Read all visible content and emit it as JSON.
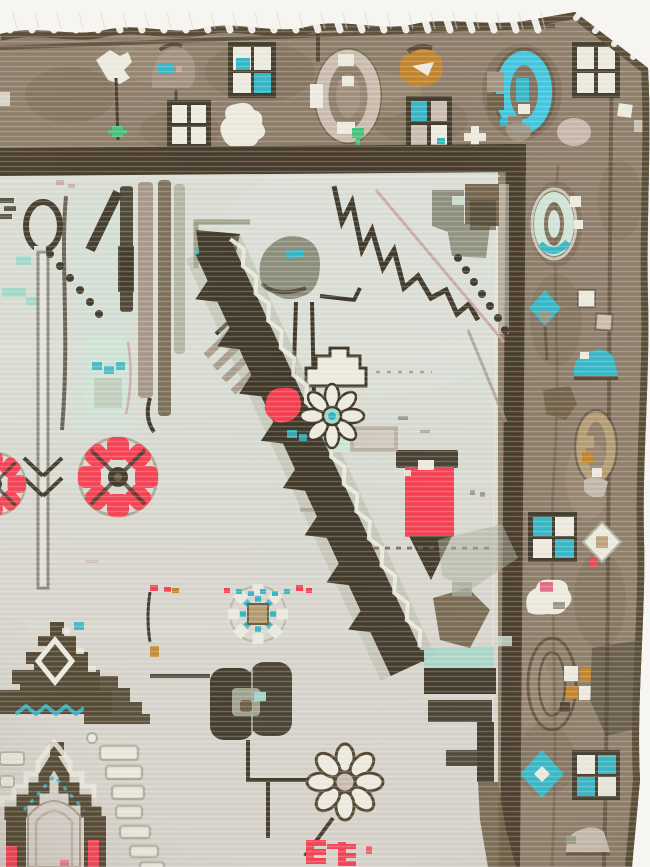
{
  "canvas": {
    "width": 650,
    "height": 867
  },
  "scene": {
    "type": "photograph",
    "subject": "Top corner detail of a worn vintage hand-knotted wool rug photographed on a white background, with fringe along the top edge",
    "no_visible_text": true,
    "regions": {
      "top_border_motifs": [
        "white-flower-sprig",
        "taupe-palmette",
        "teal-white-windowpane",
        "white-windowpane",
        "white-rosette-blob",
        "beige-oval-rosette",
        "orange-palmette",
        "mixed-windowpane",
        "white-cross",
        "turquoise-oval-rosette",
        "corner-white-windowpane",
        "green-sprout"
      ],
      "right_border_motifs": [
        "mint-oval-rosette",
        "white-square-chain",
        "teal-diamond-flower",
        "teal-mound",
        "tan-oval-rosette",
        "teal-checkerboard",
        "white-diamond",
        "white-blob-with-pink",
        "concentric-oval-with-squares",
        "teal-diamond-medallion",
        "teal-white-checkerboard",
        "beige-mound"
      ],
      "field_motifs": [
        "looped-spindle-pole",
        "vertical-bar-cluster",
        "bird-like-palmette",
        "stepped-cloud",
        "zigzag-vine",
        "pink-diagonal-abrash-line",
        "sawtooth-diagonal-leaf",
        "red-pinwheel-rosettes",
        "mint-bud",
        "daisy-with-teal-center",
        "red-pendant-flower",
        "teal-dotted-rosette",
        "dark-olive-double-flower",
        "outlined-pinwheel-flower",
        "red-comb-motifs",
        "stepped-pyramid",
        "stepped-gable-with-red-bars",
        "white-step-ladder",
        "teal-zigzag-line"
      ]
    }
  },
  "palette": {
    "photoBg": "#f6f5f1",
    "field": "#d8dcd3",
    "fieldWarm": "#d7cec8",
    "borderBrown": "#8b7a66",
    "borderShade": "#74634d",
    "borderLight": "#a2907a",
    "edgeDark": "#52452f",
    "guardDark": "#443726",
    "darkOlive": "#3e3626",
    "chocolate": "#4e422c",
    "brown": "#6b5b41",
    "oliveGray": "#8c8d7a",
    "taupe": "#a08f7e",
    "grayGreen": "#95997f",
    "sage": "#a8ab97",
    "red": "#f63d50",
    "pinkBright": "#e26b84",
    "orange": "#c08127",
    "teal": "#31b6c6",
    "turquoise": "#3cc6e0",
    "aqua": "#9fd6c8",
    "mint": "#cfe4d6",
    "tan": "#b2996f",
    "beige": "#c9bcae",
    "whiteMotif": "#edebdf",
    "pinkLine": "#c7a09c",
    "green": "#46c07c",
    "fringe": "#f6f5f0"
  }
}
